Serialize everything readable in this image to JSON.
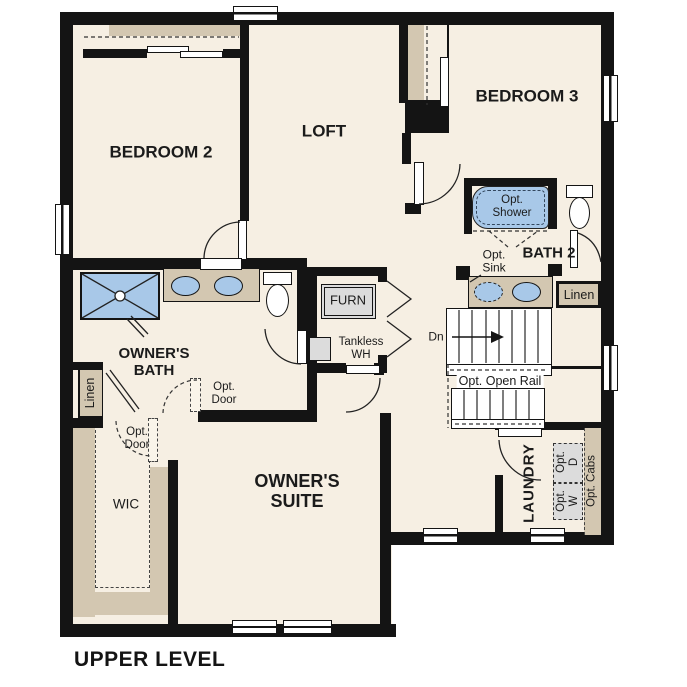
{
  "title": "UPPER LEVEL",
  "rooms": {
    "bedroom2": "BEDROOM 2",
    "loft": "LOFT",
    "bedroom3": "BEDROOM 3",
    "bath2": "BATH 2",
    "owners_bath": "OWNER'S\nBATH",
    "owners_suite": "OWNER'S\nSUITE",
    "wic": "WIC",
    "laundry": "LAUNDRY"
  },
  "features": {
    "opt_shower": "Opt.\nShower",
    "opt_sink": "Opt.\nSink",
    "bath2_linen": "Linen",
    "owners_linen": "Linen",
    "furnace": "FURN",
    "tankless_wh": "Tankless\nWH",
    "stairs_dn": "Dn",
    "opt_open_rail": "Opt. Open Rail",
    "opt_door_bath": "Opt.\nDoor",
    "opt_door_wic": "Opt.\nDoor",
    "opt_dryer": "Opt.\nD",
    "opt_washer": "Opt.\nW",
    "opt_cabs": "Opt. Cabs"
  },
  "colors": {
    "wall": "#141414",
    "floor": "#f6efe3",
    "cabinet_tan": "#d3c7b1",
    "fixture_blue": "#a8c8e8",
    "optional_gray": "#dcdcdc"
  }
}
